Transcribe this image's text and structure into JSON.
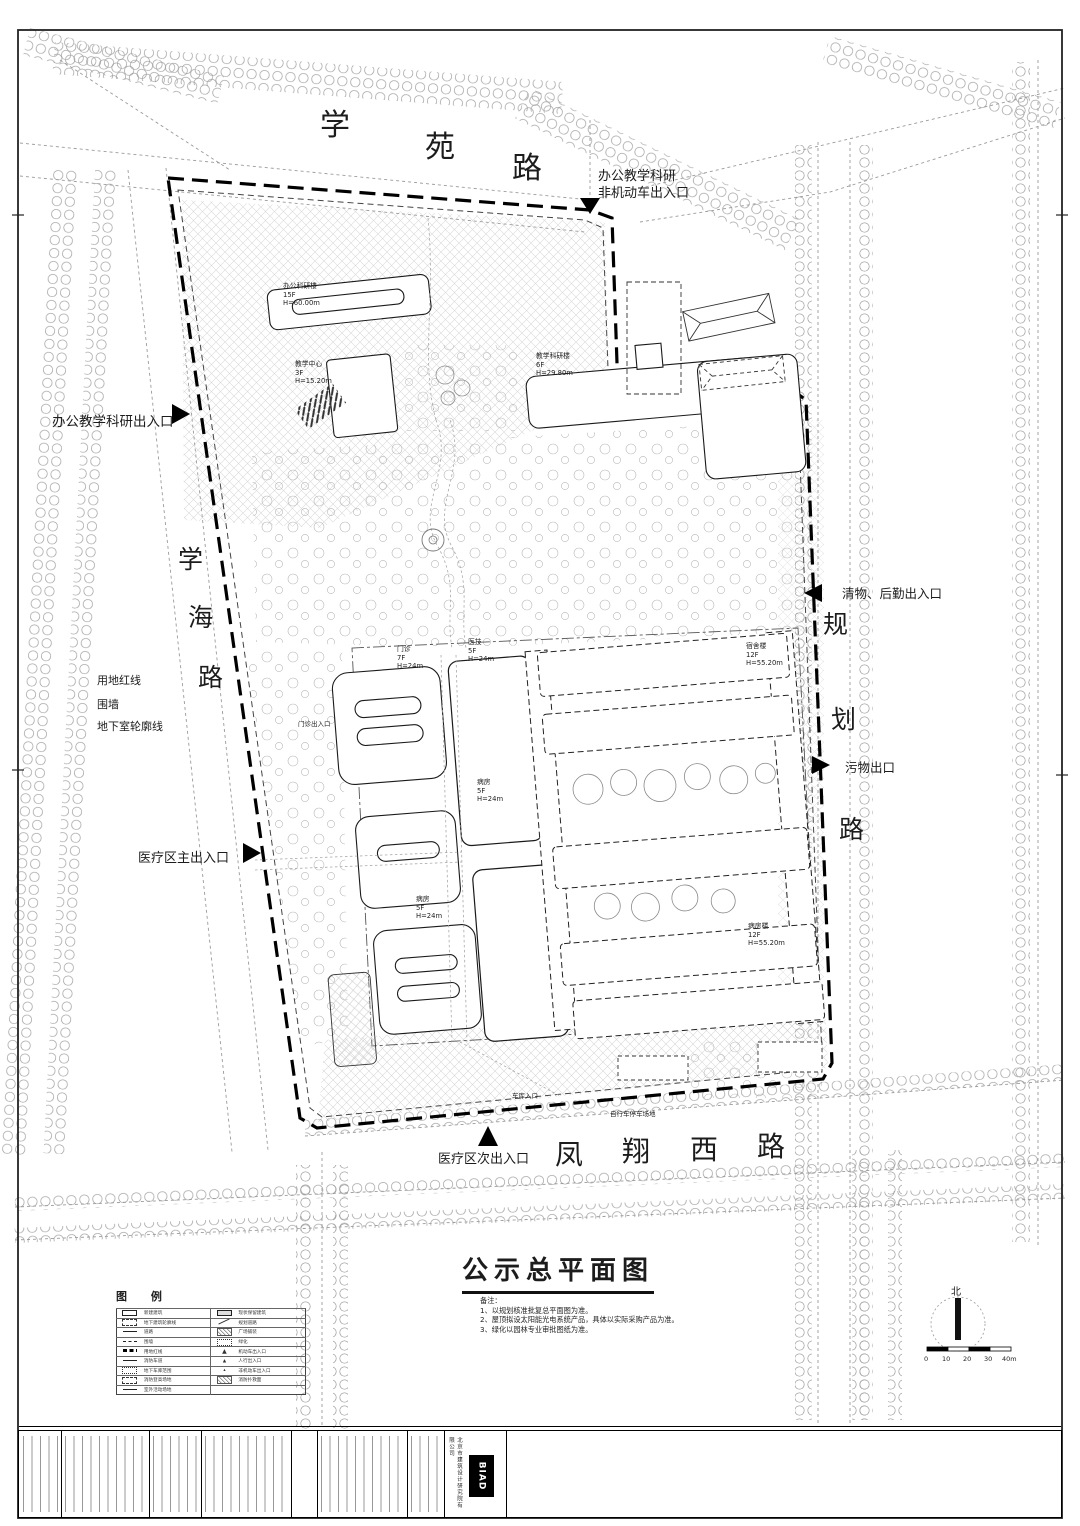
{
  "sheet": {
    "title": "公示总平面图",
    "north_label": "北"
  },
  "roads": {
    "xueyuan": [
      "学",
      "苑",
      "路"
    ],
    "xuehai": [
      "学",
      "海",
      "路"
    ],
    "guihua": [
      "规",
      "划",
      "路"
    ],
    "fengxiang": [
      "凤",
      "翔",
      "西",
      "路"
    ]
  },
  "entrances": {
    "top": "办公教学科研\n非机动车出入口",
    "left": "办公教学科研出入口",
    "clean": "清物、后勤出入口",
    "waste": "污物出口",
    "main": "医疗区主出入口",
    "secondary": "医疗区次出入口"
  },
  "site_lines": {
    "red_line": "用地红线",
    "wall": "围墙",
    "basement": "地下室轮廓线"
  },
  "buildings": {
    "b1": "办公科研楼\n15F\nH=60.00m",
    "b2": "教学科研楼\n6F\nH=29.80m",
    "b3": "教学中心\n3F\nH=15.20m",
    "b4": "门诊\n7F\nH=24m",
    "b5": "医技\n5F\nH=24m",
    "b6": "病房\n5F\nH=24m",
    "b7": "病房\n5F\nH=24m",
    "b8": "宿舍楼\n12F\nH=55.20m",
    "b9": "病房楼\n12F\nH=55.20m"
  },
  "site_labels": {
    "outpatient": "门诊出入口",
    "garage": "车库入口",
    "bike": "自行车停车场地"
  },
  "notes": {
    "heading": "备注：",
    "body": "1、以规划核准批复总平面图为准。\n2、屋顶拟设太阳能光电系统产品，具体以实际采购产品为准。\n3、绿化以园林专业审批图纸为准。"
  },
  "legend": {
    "title": "图 例",
    "rows": [
      {
        "l": "新建建筑",
        "r": "现状保留建筑"
      },
      {
        "l": "地下建筑轮廓线",
        "r": "规划道路"
      },
      {
        "l": "道路",
        "r": "广场铺装"
      },
      {
        "l": "围墙",
        "r": "绿化"
      },
      {
        "l": "用地红线",
        "r": "机动车出入口"
      },
      {
        "l": "消防车道",
        "r": "人行出入口"
      },
      {
        "l": "地下车库范围",
        "r": "非机动车出入口"
      },
      {
        "l": "消防登高场地",
        "r": "消防扑救面"
      },
      {
        "l": "室外活动场地",
        "r": ""
      }
    ]
  },
  "scale_bar": {
    "ticks": [
      "0",
      "10",
      "20",
      "30",
      "40m"
    ]
  },
  "title_block": {
    "logo": "BIAD",
    "company": "北京市建筑设计研究院有限公司"
  },
  "colors": {
    "line": "#1a1a1a",
    "road": "#9a9a9a",
    "tree": "#a3a3a3",
    "boundary": "#000000"
  }
}
